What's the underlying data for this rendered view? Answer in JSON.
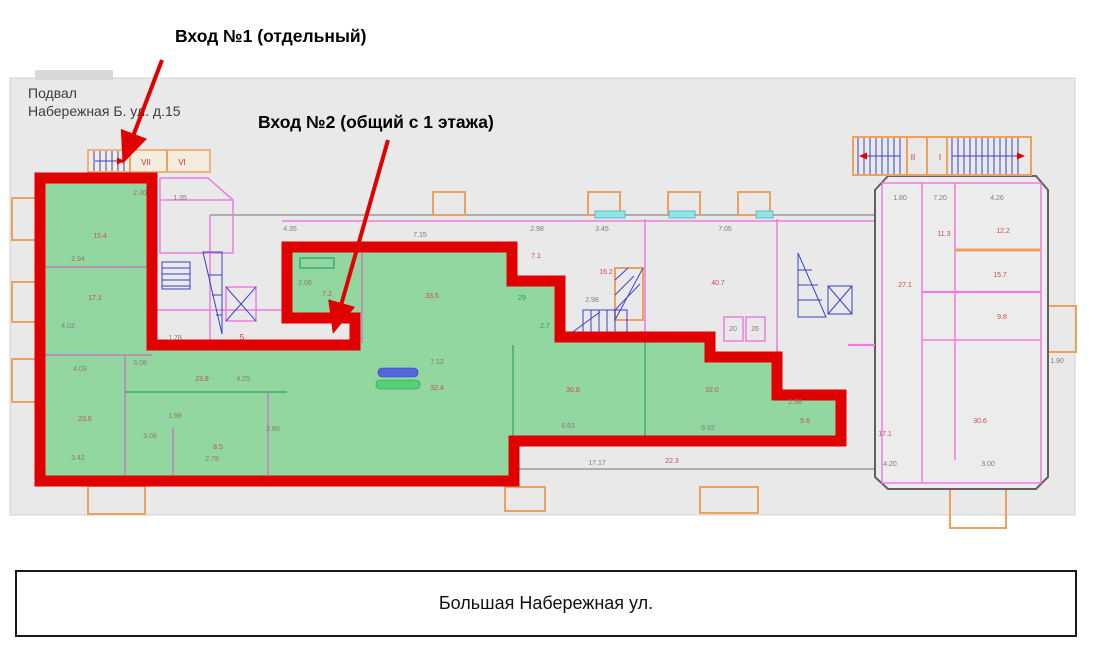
{
  "annotations": {
    "entrance1": "Вход №1 (отдельный)",
    "entrance2": "Вход №2 (общий с 1 этажа)"
  },
  "plan": {
    "title_line1": "Подвал",
    "title_line2": "Набережная Б. ул. д.15",
    "labels": [
      {
        "x": 146,
        "y": 165,
        "t": "VII",
        "c": "roman"
      },
      {
        "x": 182,
        "y": 165,
        "t": "VI",
        "c": "roman"
      },
      {
        "x": 913,
        "y": 160,
        "t": "II",
        "c": "roman"
      },
      {
        "x": 940,
        "y": 160,
        "t": "I",
        "c": "roman"
      },
      {
        "x": 242,
        "y": 340,
        "t": "5",
        "c": "roman"
      },
      {
        "x": 140,
        "y": 195,
        "t": "2.30",
        "c": "dim"
      },
      {
        "x": 180,
        "y": 200,
        "t": "1.35",
        "c": "dim"
      },
      {
        "x": 290,
        "y": 231,
        "t": "4.35",
        "c": "dim"
      },
      {
        "x": 420,
        "y": 237,
        "t": "7.15",
        "c": "dim"
      },
      {
        "x": 537,
        "y": 231,
        "t": "2.98",
        "c": "dim"
      },
      {
        "x": 602,
        "y": 231,
        "t": "3.45",
        "c": "dim"
      },
      {
        "x": 725,
        "y": 231,
        "t": "7.05",
        "c": "dim"
      },
      {
        "x": 900,
        "y": 200,
        "t": "1.80",
        "c": "dim"
      },
      {
        "x": 940,
        "y": 200,
        "t": "7.20",
        "c": "dim"
      },
      {
        "x": 997,
        "y": 200,
        "t": "4.26",
        "c": "dim"
      },
      {
        "x": 100,
        "y": 238,
        "t": "15.4",
        "c": "red"
      },
      {
        "x": 78,
        "y": 261,
        "t": "2.94",
        "c": "dim"
      },
      {
        "x": 95,
        "y": 300,
        "t": "17.1",
        "c": "red"
      },
      {
        "x": 68,
        "y": 328,
        "t": "4.02",
        "c": "dim"
      },
      {
        "x": 80,
        "y": 371,
        "t": "4.03",
        "c": "dim"
      },
      {
        "x": 85,
        "y": 421,
        "t": "23.6",
        "c": "red"
      },
      {
        "x": 78,
        "y": 460,
        "t": "3.42",
        "c": "dim"
      },
      {
        "x": 140,
        "y": 365,
        "t": "3.08",
        "c": "dim"
      },
      {
        "x": 202,
        "y": 381,
        "t": "23.8",
        "c": "red"
      },
      {
        "x": 243,
        "y": 381,
        "t": "4.25",
        "c": "dim"
      },
      {
        "x": 175,
        "y": 418,
        "t": "1.98",
        "c": "dim"
      },
      {
        "x": 150,
        "y": 438,
        "t": "3.08",
        "c": "dim"
      },
      {
        "x": 218,
        "y": 449,
        "t": "8.5",
        "c": "red"
      },
      {
        "x": 212,
        "y": 461,
        "t": "2.78",
        "c": "dim"
      },
      {
        "x": 273,
        "y": 431,
        "t": "2.80",
        "c": "dim"
      },
      {
        "x": 175,
        "y": 340,
        "t": "1.78",
        "c": "dim"
      },
      {
        "x": 305,
        "y": 285,
        "t": "2.08",
        "c": "dim"
      },
      {
        "x": 327,
        "y": 296,
        "t": "7.2",
        "c": "red"
      },
      {
        "x": 432,
        "y": 298,
        "t": "33.5",
        "c": "red"
      },
      {
        "x": 522,
        "y": 300,
        "t": "29",
        "c": "green"
      },
      {
        "x": 545,
        "y": 328,
        "t": "2.7",
        "c": "green"
      },
      {
        "x": 536,
        "y": 258,
        "t": "7.1",
        "c": "red"
      },
      {
        "x": 592,
        "y": 302,
        "t": "2.98",
        "c": "dim"
      },
      {
        "x": 606,
        "y": 274,
        "t": "16.2",
        "c": "red"
      },
      {
        "x": 718,
        "y": 285,
        "t": "40.7",
        "c": "red"
      },
      {
        "x": 733,
        "y": 331,
        "t": "20",
        "c": "dim"
      },
      {
        "x": 755,
        "y": 331,
        "t": "26",
        "c": "dim"
      },
      {
        "x": 437,
        "y": 364,
        "t": "7.12",
        "c": "dim"
      },
      {
        "x": 437,
        "y": 390,
        "t": "32.4",
        "c": "red"
      },
      {
        "x": 573,
        "y": 392,
        "t": "30.8",
        "c": "red"
      },
      {
        "x": 568,
        "y": 428,
        "t": "8.63",
        "c": "dim"
      },
      {
        "x": 712,
        "y": 392,
        "t": "32.0",
        "c": "red"
      },
      {
        "x": 708,
        "y": 430,
        "t": "6.92",
        "c": "dim"
      },
      {
        "x": 795,
        "y": 404,
        "t": "2.98",
        "c": "dim"
      },
      {
        "x": 805,
        "y": 423,
        "t": "5.6",
        "c": "red"
      },
      {
        "x": 597,
        "y": 465,
        "t": "17.17",
        "c": "dim"
      },
      {
        "x": 672,
        "y": 463,
        "t": "22.3",
        "c": "red"
      },
      {
        "x": 905,
        "y": 287,
        "t": "27.1",
        "c": "red"
      },
      {
        "x": 944,
        "y": 236,
        "t": "11.3",
        "c": "red"
      },
      {
        "x": 1003,
        "y": 233,
        "t": "12.2",
        "c": "red"
      },
      {
        "x": 1000,
        "y": 277,
        "t": "15.7",
        "c": "red"
      },
      {
        "x": 1002,
        "y": 319,
        "t": "9.8",
        "c": "red"
      },
      {
        "x": 885,
        "y": 436,
        "t": "17.1",
        "c": "red"
      },
      {
        "x": 980,
        "y": 423,
        "t": "30.6",
        "c": "red"
      },
      {
        "x": 890,
        "y": 466,
        "t": "4.20",
        "c": "dim"
      },
      {
        "x": 988,
        "y": 466,
        "t": "3.00",
        "c": "dim"
      },
      {
        "x": 1057,
        "y": 363,
        "t": "1.90",
        "c": "dim"
      }
    ]
  },
  "street": {
    "label": "Большая Набережная ул."
  },
  "colors": {
    "red": "#e00000",
    "green": "#92d7a0",
    "wall": "#ee7ce0",
    "orange": "#eaa25e",
    "blue": "#3a42c4",
    "cyan": "#8fe6e6",
    "gray_bg": "#e9e9e9"
  }
}
